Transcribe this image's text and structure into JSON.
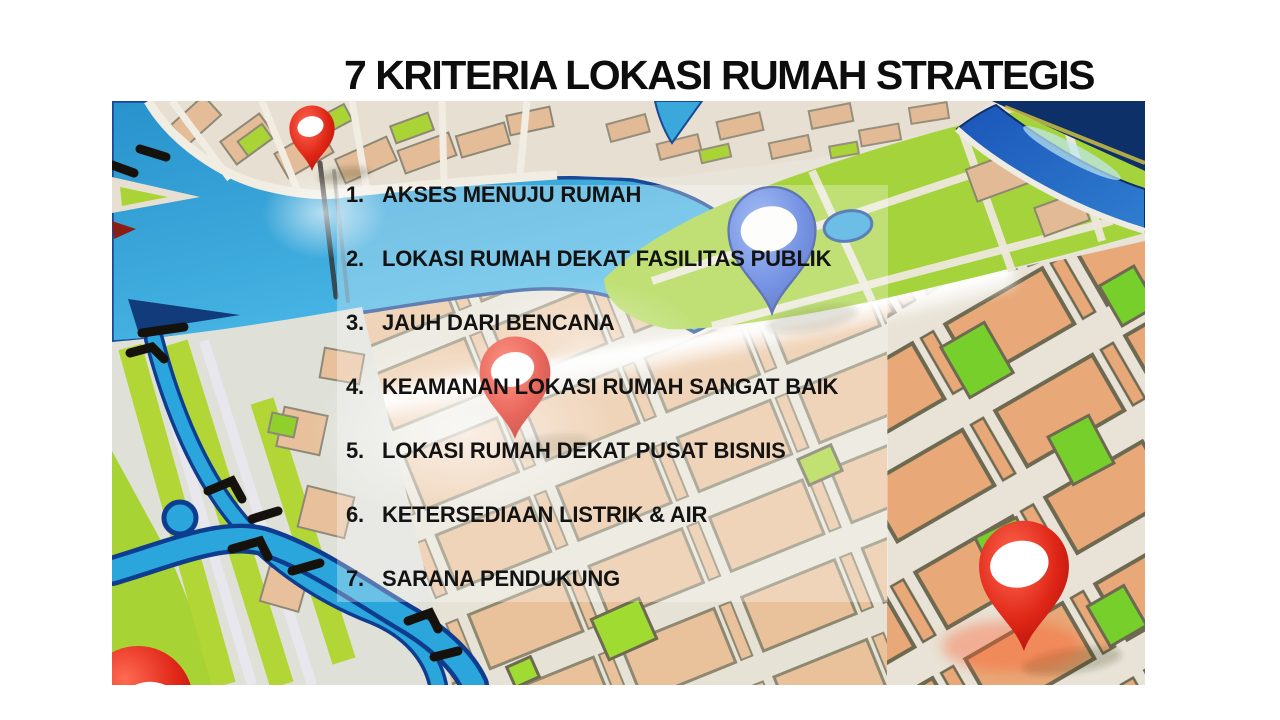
{
  "slide": {
    "title": "7 KRITERIA LOKASI RUMAH STRATEGIS"
  },
  "list": {
    "items": [
      {
        "number": "1.",
        "label": "AKSES MENUJU RUMAH"
      },
      {
        "number": "2.",
        "label": "LOKASI RUMAH DEKAT FASILITAS PUBLIK"
      },
      {
        "number": "3.",
        "label": "JAUH DARI BENCANA"
      },
      {
        "number": "4.",
        "label": "KEAMANAN LOKASI RUMAH SANGAT BAIK"
      },
      {
        "number": "5.",
        "label": "LOKASI RUMAH DEKAT PUSAT BISNIS"
      },
      {
        "number": "6.",
        "label": "KETERSEDIAAN LISTRIK & AIR"
      },
      {
        "number": "7.",
        "label": "SARANA PENDUKUNG"
      }
    ]
  },
  "map": {
    "pins": [
      {
        "name": "red-pin-top-left",
        "color": "#d8241a"
      },
      {
        "name": "red-pin-center",
        "color": "#d8241a"
      },
      {
        "name": "blue-pin",
        "color": "#3a64d8"
      },
      {
        "name": "red-pin-bottom-right",
        "color": "#d8241a"
      },
      {
        "name": "red-pin-bottom-left",
        "color": "#d8241a"
      }
    ],
    "palette": {
      "water": "#2f9fd6",
      "river_top_right": "#1e5fc4",
      "park_green_left": "#b2d636",
      "park_green_right": "#76cf2a",
      "block_salmon": "#e9c29c",
      "block_terracotta": "#e8a878",
      "street": "#e8e4d8",
      "bridge_marks": "#15120e"
    }
  }
}
